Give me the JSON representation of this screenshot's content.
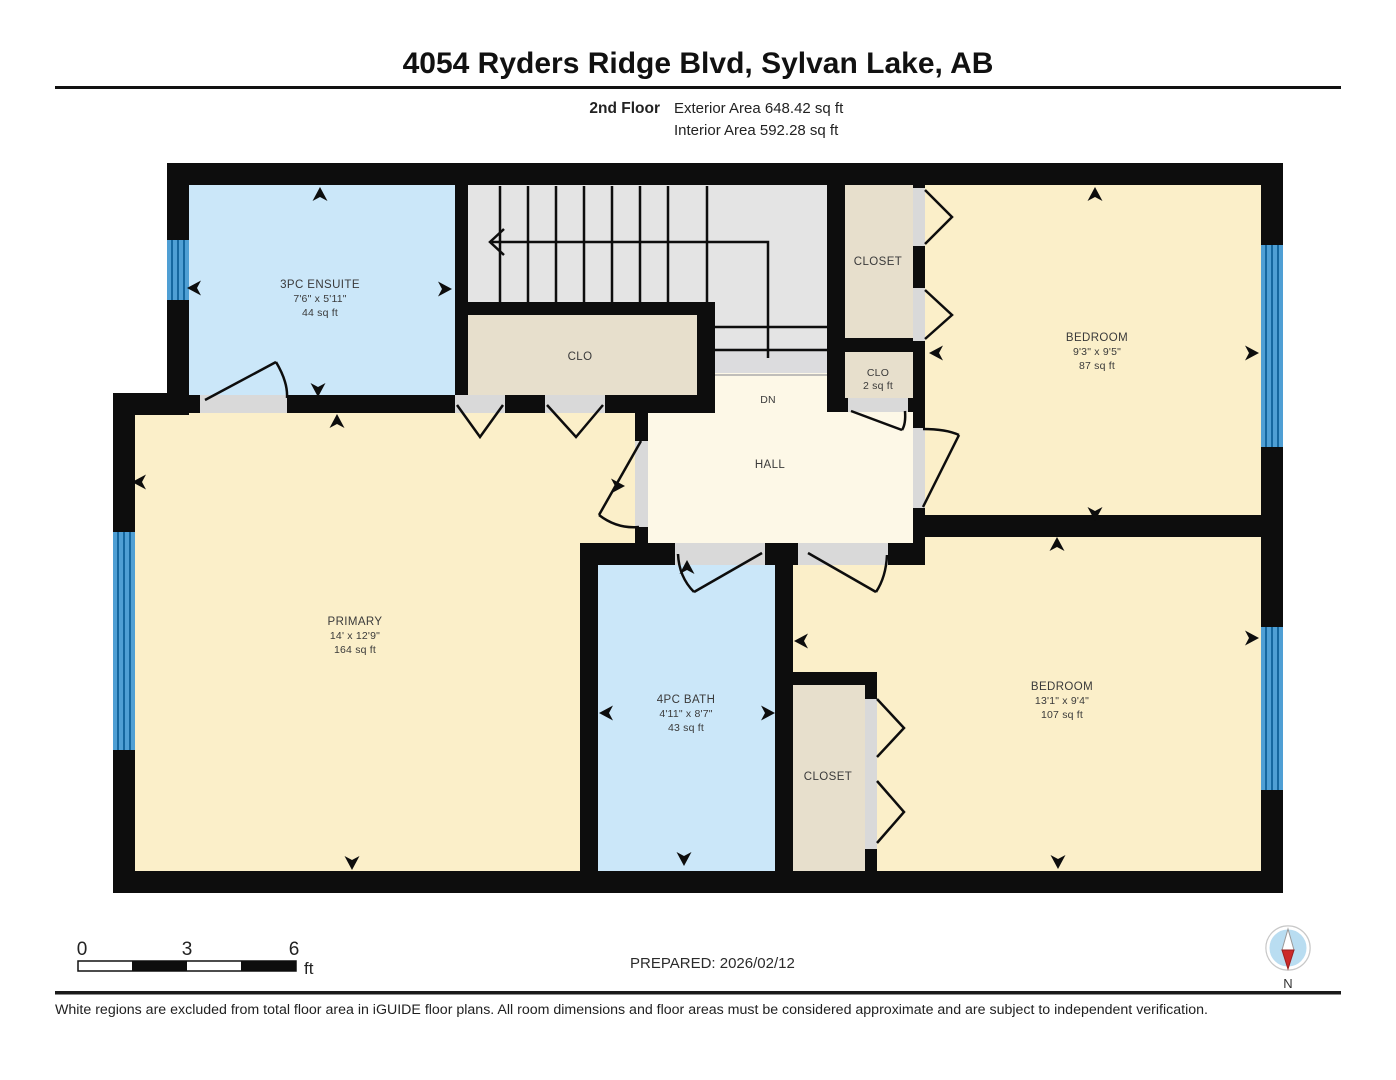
{
  "header": {
    "title": "4054 Ryders Ridge Blvd, Sylvan Lake, AB",
    "floor_label": "2nd Floor",
    "exterior_area": "Exterior Area 648.42 sq ft",
    "interior_area": "Interior Area 592.28 sq ft"
  },
  "rooms": {
    "ensuite": {
      "name": "3PC ENSUITE",
      "dims": "7'6\" x 5'11\"",
      "area": "44 sq ft"
    },
    "primary": {
      "name": "PRIMARY",
      "dims": "14' x 12'9\"",
      "area": "164 sq ft"
    },
    "bath": {
      "name": "4PC BATH",
      "dims": "4'11\" x 8'7\"",
      "area": "43 sq ft"
    },
    "bedroom_top": {
      "name": "BEDROOM",
      "dims": "9'3\" x 9'5\"",
      "area": "87 sq ft"
    },
    "bedroom_bottom": {
      "name": "BEDROOM",
      "dims": "13'1\" x 9'4\"",
      "area": "107 sq ft"
    },
    "closet_top": {
      "name": "CLOSET"
    },
    "closet_bottom": {
      "name": "CLOSET"
    },
    "clo_under_stairs": {
      "name": "CLO"
    },
    "clo_small": {
      "name": "CLO",
      "area": "2 sq ft"
    },
    "hall": {
      "name": "HALL"
    },
    "stairs": {
      "down_label": "DN"
    }
  },
  "scale_bar": {
    "ticks": [
      "0",
      "3",
      "6"
    ],
    "unit": "ft"
  },
  "footer": {
    "prepared": "PREPARED: 2026/02/12",
    "compass_label": "N",
    "disclaimer": "White regions are excluded from total floor area in iGUIDE floor plans. All room dimensions and floor areas must be considered approximate and are subject to independent verification."
  },
  "colors": {
    "wall": "#0d0d0d",
    "room_cream": "#fbefc9",
    "hall_cream": "#fdf8e7",
    "closet_tan": "#e7dfcc",
    "wet_room_blue": "#cbe7f9",
    "stairs_gray": "#e4e4e4",
    "window_blue": "#4f9fd4",
    "compass_red": "#cc2a2a",
    "compass_circle": "#b9ddf1"
  }
}
